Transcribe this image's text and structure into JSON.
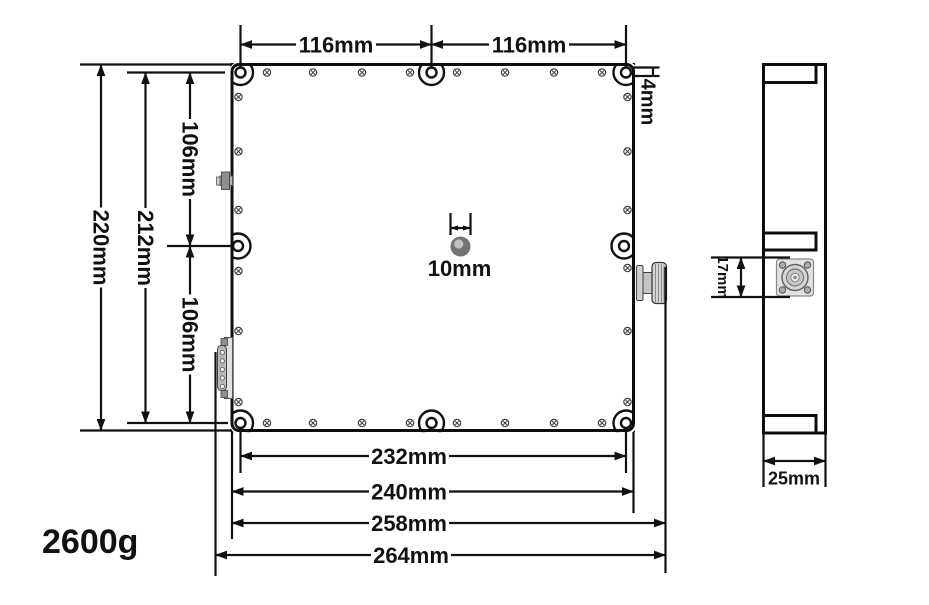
{
  "views": {
    "top": {
      "label": "top-view-of-enclosure",
      "dim_116_left": "116mm",
      "dim_116_right": "116mm",
      "dim_4": "4mm",
      "dim_220": "220mm",
      "dim_212": "212mm",
      "dim_106_upper": "106mm",
      "dim_106_lower": "106mm",
      "dim_10": "10mm",
      "dim_232": "232mm",
      "dim_240": "240mm",
      "dim_258": "258mm",
      "dim_264": "264mm"
    },
    "side": {
      "label": "side-view-of-enclosure",
      "dim_17": "17mm",
      "dim_25": "25mm"
    }
  },
  "weight": "2600g",
  "components": {
    "left_upper": "sma-connector",
    "left_lower": "db9-connector",
    "right_edge": "n-connector-side",
    "side_view_face": "n-connector-front",
    "center": "center-hole",
    "mounting_holes": 8,
    "fasteners": "phillips-screws"
  },
  "colors": {
    "line": "#111111",
    "background": "#ffffff",
    "hole_outer": "#747474",
    "hole_inner": "#c2c2c2",
    "connector_gray": "#c0c0c0"
  }
}
